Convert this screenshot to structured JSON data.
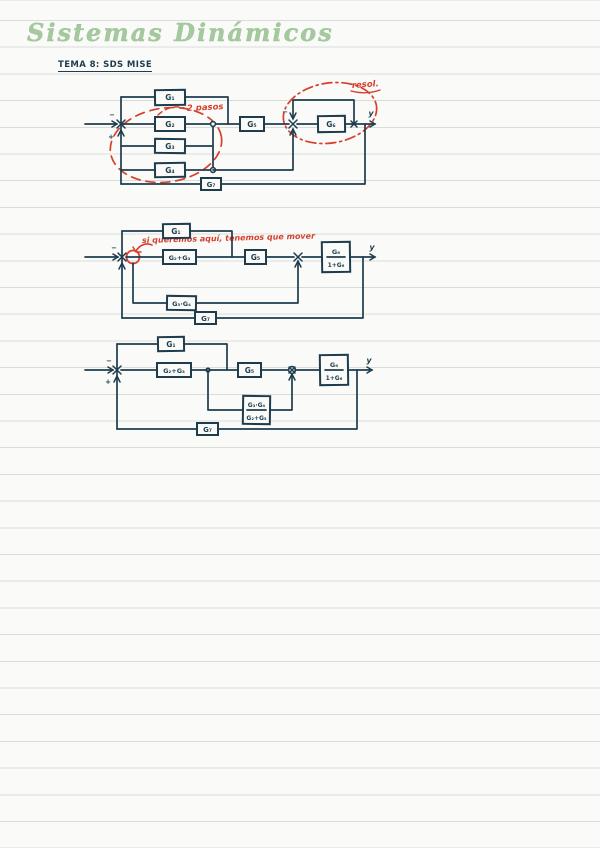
{
  "page": {
    "title": "Sistemas Dinámicos",
    "subtitle": "TEMA 8: SDS MISE"
  },
  "colors": {
    "ink": "#1e3c4c",
    "annotation_red": "#d5402e",
    "title_green": "#a6c89f",
    "paper": "#fafbf9",
    "ruled_line": "#d9dcd9"
  },
  "d1": {
    "g1": "G₁",
    "g2": "G₂",
    "g3": "G₃",
    "g4": "G₄",
    "g5": "G₅",
    "g6": "G₆",
    "g7": "G₇",
    "s1_minus": "−",
    "s1_plus": "+",
    "s2_minus": "−",
    "out": "y",
    "note_steps": "2 pasos",
    "note_resolve": "resol."
  },
  "d2": {
    "g1": "G₁",
    "g23": "G₂+G₃",
    "g5": "G₅",
    "g34": "G₃·G₄",
    "g6_num": "G₆",
    "g6_den": "1+G₆",
    "g7": "G₇",
    "s1_minus": "−",
    "out": "y",
    "note": "si queremos aquí, tenemos que mover"
  },
  "d3": {
    "g1": "G₁",
    "g23": "G₂+G₃",
    "g5": "G₅",
    "frac_num": "G₃·G₄",
    "frac_den": "G₂+G₃",
    "g6_num": "G₆",
    "g6_den": "1+G₆",
    "g7": "G₇",
    "s1_minus": "−",
    "s1_plus": "+",
    "out": "y"
  }
}
